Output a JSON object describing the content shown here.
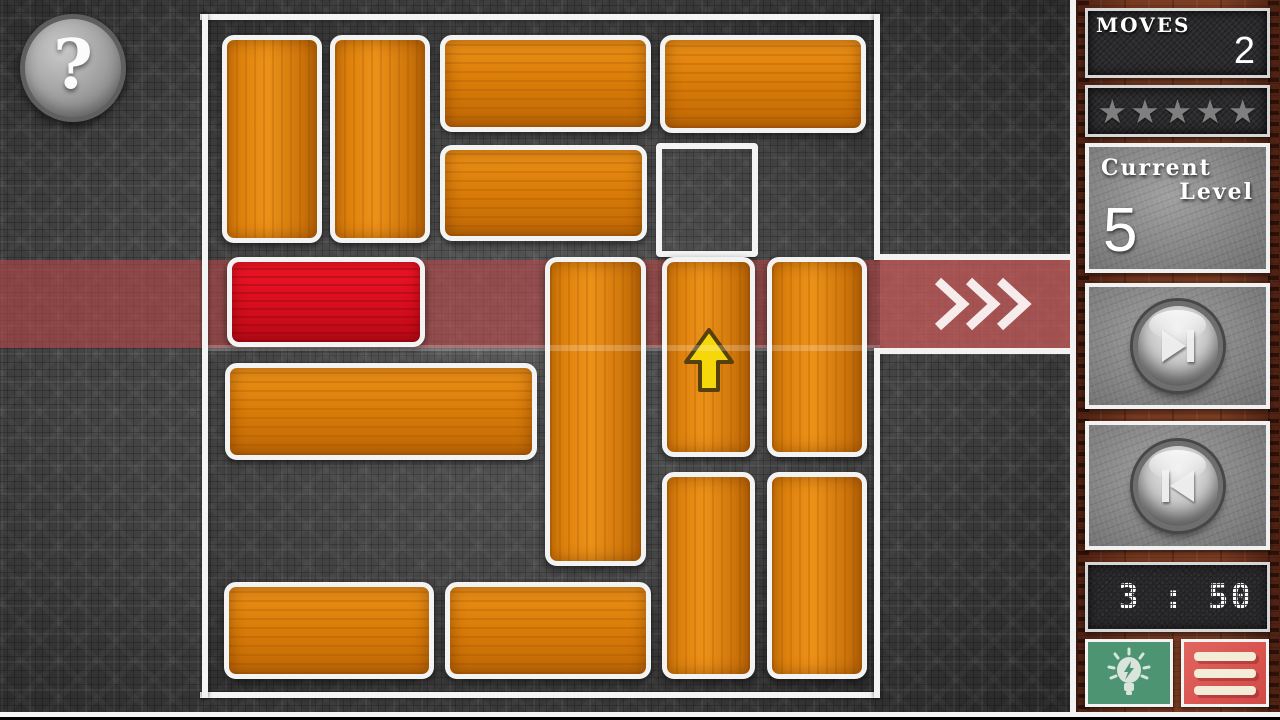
{
  "hud": {
    "help_glyph": "?",
    "moves_label": "MOVES",
    "moves_value": "2",
    "stars_total": 5,
    "star_glyph": "★",
    "level_label_line1": "Current",
    "level_label_line2": "Level",
    "level_value": "5",
    "timer_value": "3 : 50"
  },
  "icons": {
    "help": "question-mark",
    "next_level": "skip-next",
    "prev_level": "skip-previous",
    "hint": "lightbulb",
    "menu": "hamburger",
    "exit": "triple-chevron-right",
    "hint_move": "up-arrow"
  },
  "colors": {
    "orange_block": "#d87b08",
    "red_block": "#d60e1d",
    "block_border": "#f3f3f3",
    "exit_stripe": "#b94848",
    "board_bg": "#434343",
    "wood": "#773a21",
    "panel_dark": "#2b2b2d",
    "panel_gray": "#8c8c8c",
    "green_button": "#4d9472",
    "red_button": "#d9534f",
    "star_gray": "#7f7f7f"
  },
  "board": {
    "grid_cols": 6,
    "grid_rows": 6,
    "exit_row": 3,
    "exit_side": "right",
    "hint_cell": {
      "col": 5,
      "row": 2,
      "rect": [
        656,
        143,
        102,
        114
      ]
    },
    "blocks": [
      {
        "name": "orange-block-c1-r1",
        "type": "orange",
        "dir": "v",
        "grid": {
          "col": 1,
          "row": 1,
          "len": 2
        },
        "rect": [
          222,
          35,
          100,
          208
        ]
      },
      {
        "name": "orange-block-c2-r1",
        "type": "orange",
        "dir": "v",
        "grid": {
          "col": 2,
          "row": 1,
          "len": 2
        },
        "rect": [
          330,
          35,
          100,
          208
        ]
      },
      {
        "name": "orange-block-c3-r1",
        "type": "orange",
        "dir": "h",
        "grid": {
          "col": 3,
          "row": 1,
          "len": 2
        },
        "rect": [
          440,
          35,
          211,
          97
        ]
      },
      {
        "name": "orange-block-c5-r1",
        "type": "orange",
        "dir": "h",
        "grid": {
          "col": 5,
          "row": 1,
          "len": 2
        },
        "rect": [
          660,
          35,
          206,
          98
        ]
      },
      {
        "name": "orange-block-c3-r2",
        "type": "orange",
        "dir": "h",
        "grid": {
          "col": 3,
          "row": 2,
          "len": 2
        },
        "rect": [
          440,
          145,
          207,
          96
        ]
      },
      {
        "name": "red-hero-block",
        "type": "red",
        "dir": "h",
        "grid": {
          "col": 1,
          "row": 3,
          "len": 2
        },
        "rect": [
          227,
          257,
          198,
          90
        ]
      },
      {
        "name": "orange-block-c4-r3",
        "type": "orange",
        "dir": "v",
        "grid": {
          "col": 4,
          "row": 3,
          "len": 3
        },
        "rect": [
          545,
          257,
          101,
          309
        ]
      },
      {
        "name": "orange-block-c5-r3",
        "type": "orange",
        "dir": "v",
        "arrow": true,
        "grid": {
          "col": 5,
          "row": 3,
          "len": 2
        },
        "rect": [
          662,
          257,
          93,
          200
        ]
      },
      {
        "name": "orange-block-c6-r3",
        "type": "orange",
        "dir": "v",
        "grid": {
          "col": 6,
          "row": 3,
          "len": 2
        },
        "rect": [
          767,
          257,
          100,
          200
        ]
      },
      {
        "name": "orange-block-c1-r4",
        "type": "orange",
        "dir": "h",
        "grid": {
          "col": 1,
          "row": 4,
          "len": 3
        },
        "rect": [
          225,
          363,
          312,
          97
        ]
      },
      {
        "name": "orange-block-c5-r5",
        "type": "orange",
        "dir": "v",
        "grid": {
          "col": 5,
          "row": 5,
          "len": 2
        },
        "rect": [
          662,
          472,
          93,
          207
        ]
      },
      {
        "name": "orange-block-c6-r5",
        "type": "orange",
        "dir": "v",
        "grid": {
          "col": 6,
          "row": 5,
          "len": 2
        },
        "rect": [
          767,
          472,
          100,
          207
        ]
      },
      {
        "name": "orange-block-c1-r6",
        "type": "orange",
        "dir": "h",
        "grid": {
          "col": 1,
          "row": 6,
          "len": 2
        },
        "rect": [
          224,
          582,
          210,
          97
        ]
      },
      {
        "name": "orange-block-c3-r6",
        "type": "orange",
        "dir": "h",
        "grid": {
          "col": 3,
          "row": 6,
          "len": 2
        },
        "rect": [
          445,
          582,
          206,
          97
        ]
      }
    ]
  }
}
